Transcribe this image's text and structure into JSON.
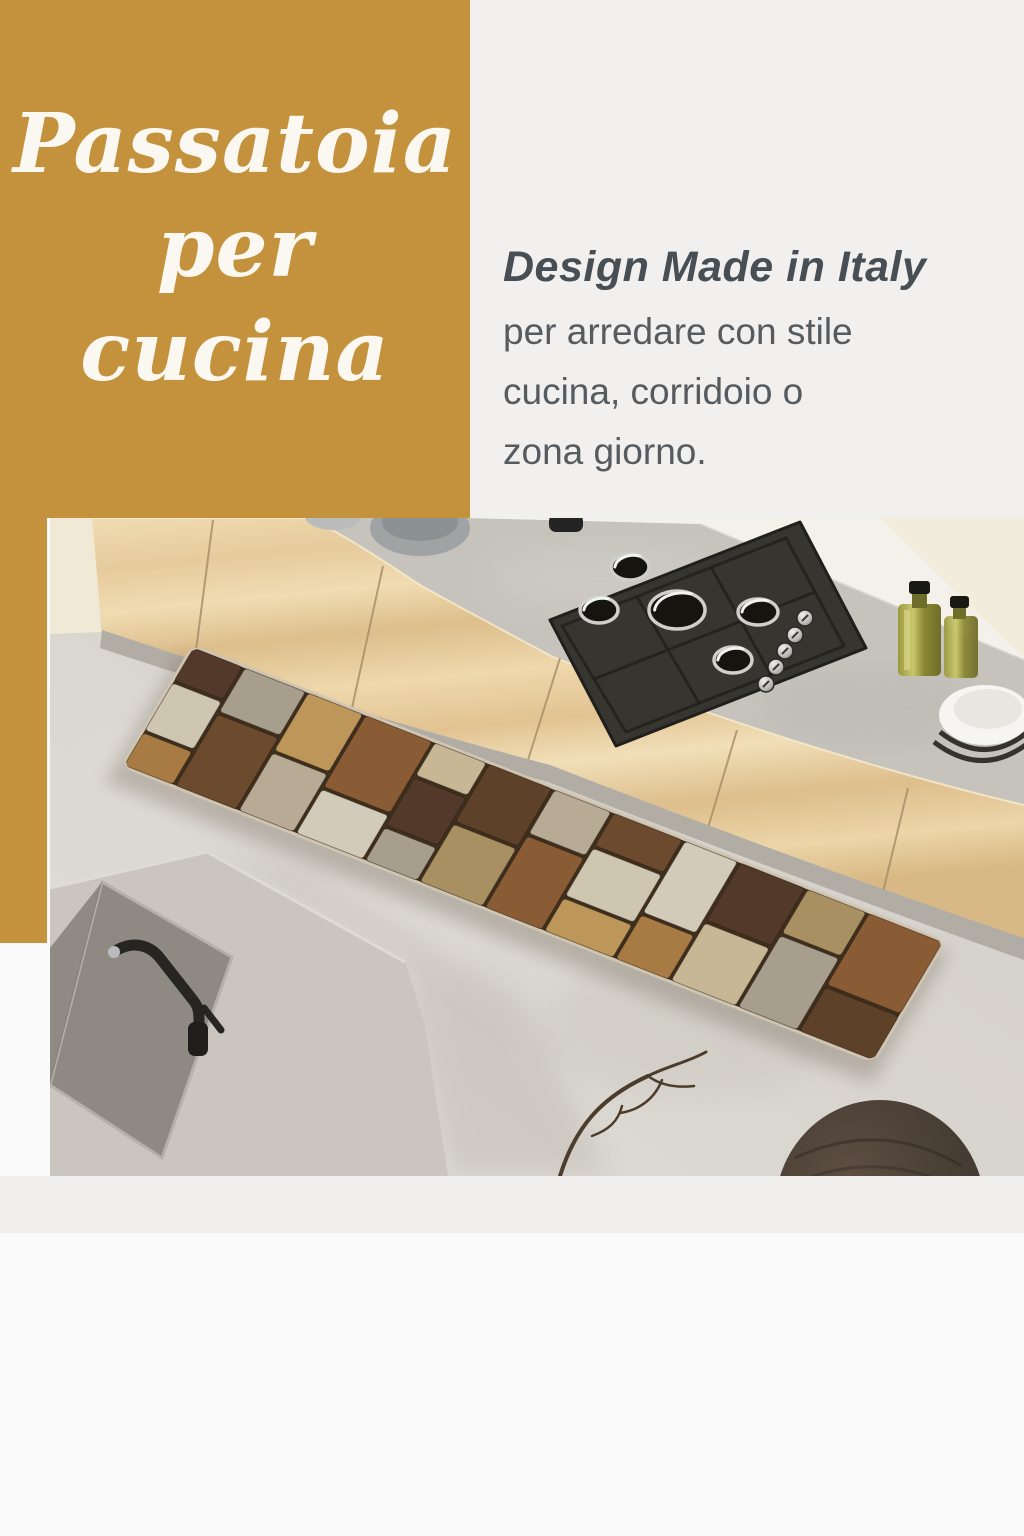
{
  "page": {
    "bg": "#fafafa",
    "panel_bg": "#f1f0ee",
    "band_bg": "#f0efed"
  },
  "hero": {
    "bg": "#c4923c",
    "text_color": "#fbf8f1",
    "title": [
      "Passatoia",
      "per cucina"
    ]
  },
  "description": {
    "heading": "Design Made in Italy",
    "heading_color": "#474e54",
    "body_color": "#565b60",
    "lines": [
      "per arredare con stile",
      "cucina, corridoio o",
      "zona giorno."
    ]
  },
  "photo": {
    "scene": "kitchen with patchwork runner rug",
    "floor": "#d6d2cb",
    "counter": "#c6c3bc",
    "wall": "#f3f1ea",
    "wood_light": "#f0dcb2",
    "wood_dark": "#ddbe8c",
    "stove": "#37352f",
    "rug_base": "#3f2f1f",
    "rug_binding": "#cfc5b2",
    "rug_palette": [
      "#53392a",
      "#6b4a2e",
      "#8a5c36",
      "#a87b45",
      "#bd965a",
      "#a99062",
      "#c7b794",
      "#cfc6b2",
      "#a79e8d",
      "#b7ab96",
      "#d3cbba",
      "#5e4129"
    ]
  }
}
